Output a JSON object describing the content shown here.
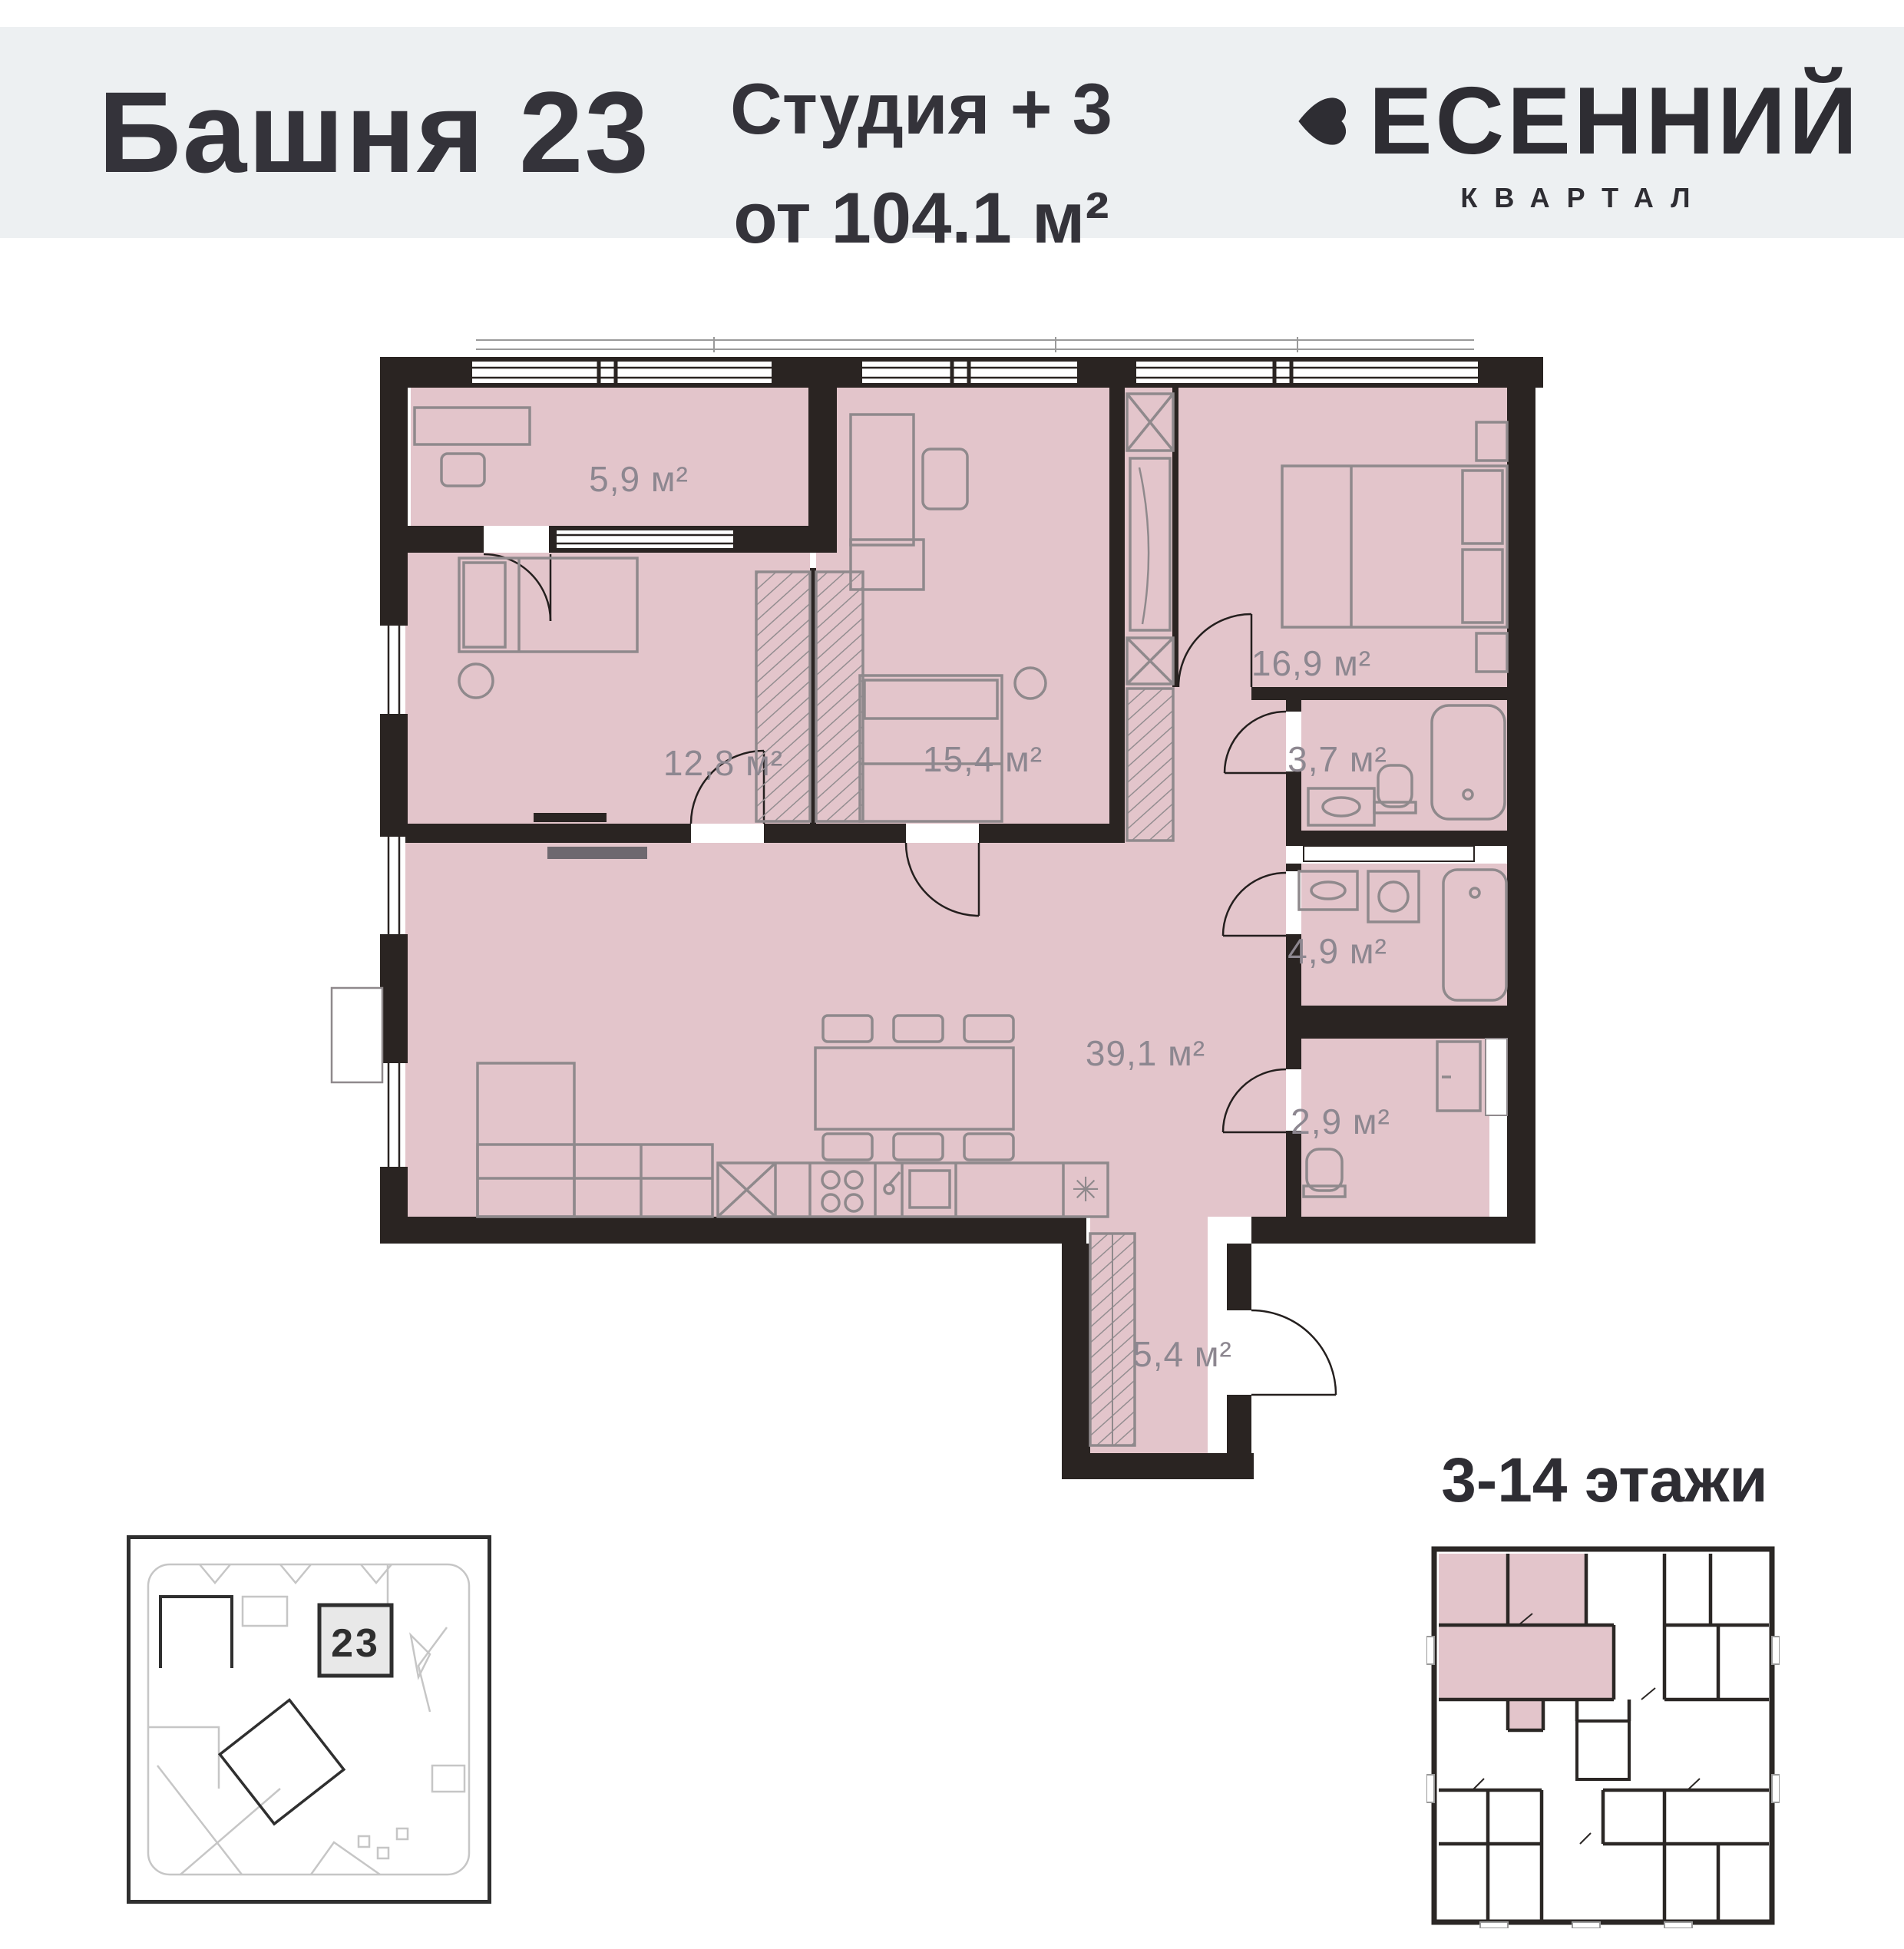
{
  "header": {
    "tower_title": "Башня 23",
    "unit_type": "Студия + 3",
    "unit_area": "от 104.1 м²",
    "brand": {
      "name": "ВЕСЕННИЙ",
      "name_after_icon": "ЕСЕННИЙ",
      "tagline": "КВАРТАЛ",
      "icon": "heart-icon"
    }
  },
  "plan": {
    "rooms": [
      {
        "name": "hall-top",
        "area_label": "5,9 м²"
      },
      {
        "name": "bedroom-left",
        "area_label": "12,8 м²"
      },
      {
        "name": "bedroom-middle",
        "area_label": "15,4 м²"
      },
      {
        "name": "bedroom-right",
        "area_label": "16,9 м²"
      },
      {
        "name": "bathroom-small",
        "area_label": "3,7 м²"
      },
      {
        "name": "living-kitchen",
        "area_label": "39,1 м²"
      },
      {
        "name": "bathroom-large",
        "area_label": "4,9 м²"
      },
      {
        "name": "wc",
        "area_label": "2,9 м²"
      },
      {
        "name": "entry-hall",
        "area_label": "5,4 м²"
      }
    ],
    "appliance_symbol": "✳"
  },
  "site_plan": {
    "building_number": "23"
  },
  "floors_plan": {
    "title": "3-14 этажи"
  },
  "colors": {
    "header_bg": "#edf0f2",
    "text_dark": "#34333a",
    "wall": "#2a2422",
    "room_fill": "#e3c5cb",
    "label_gray": "#8d8790",
    "furniture_gray": "#8f898c"
  }
}
